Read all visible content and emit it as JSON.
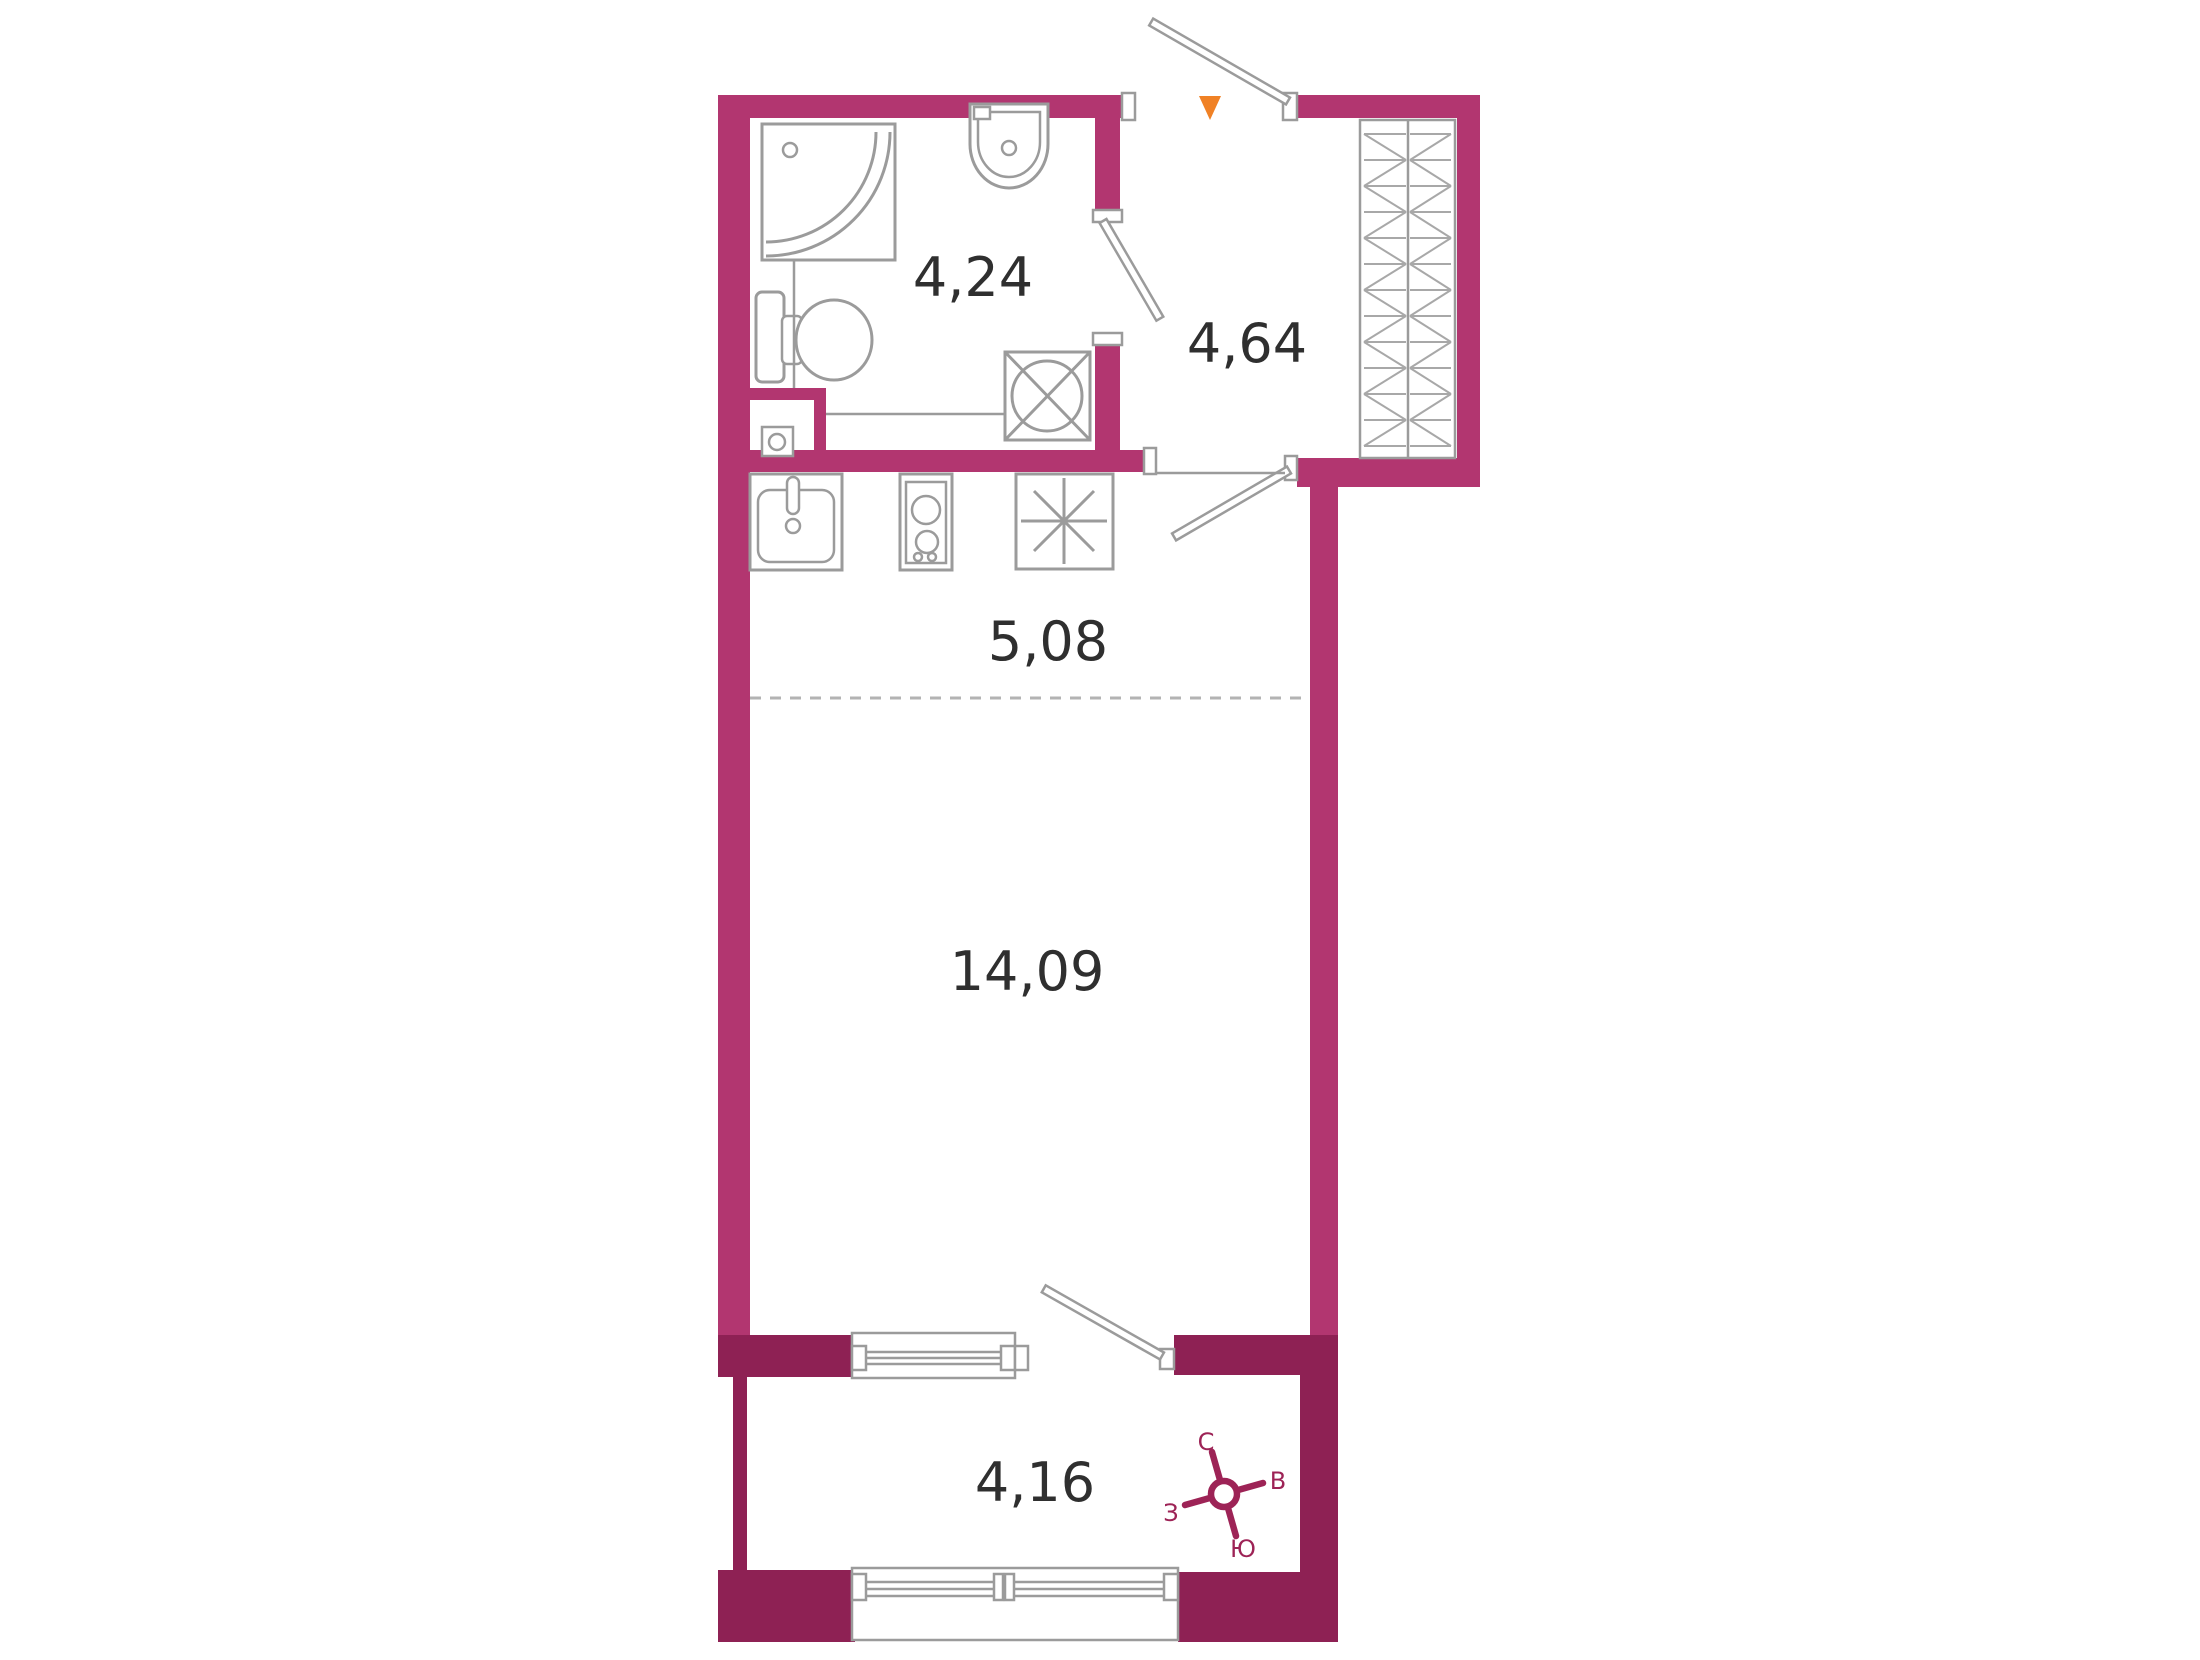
{
  "floor_plan": {
    "rooms": [
      {
        "id": "bathroom",
        "area_label": "4,24"
      },
      {
        "id": "hallway",
        "area_label": "4,64"
      },
      {
        "id": "kitchen",
        "area_label": "5,08"
      },
      {
        "id": "living_room",
        "area_label": "14,09"
      },
      {
        "id": "balcony",
        "area_label": "4,16"
      }
    ],
    "compass": {
      "north_label": "С",
      "east_label": "В",
      "south_label": "Ю",
      "west_label": "З"
    },
    "colors": {
      "wall": "#b23670",
      "wall_dark": "#8e2154",
      "fixtures": "#9b9b9b",
      "area_text": "#2f2f2f",
      "compass": "#9d2356",
      "entrance_marker": "#f08125",
      "divider_dashed": "#b3b3b3"
    }
  }
}
